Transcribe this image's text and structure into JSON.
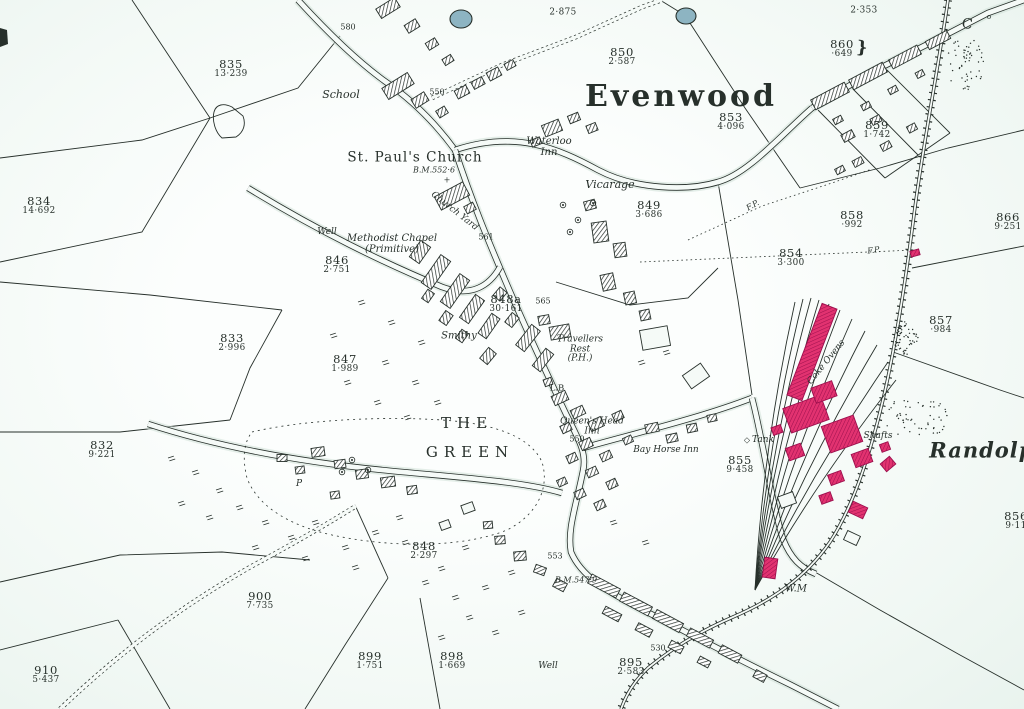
{
  "map": {
    "title": "Evenwood",
    "colors": {
      "paper": "#f5faf7",
      "ink": "#27302b",
      "pink": "#e23270",
      "pink_dark": "#9c0f4d",
      "pond": "#8db4c2",
      "road_halo": "#cfe0d7"
    },
    "parcels": [
      {
        "num": "835",
        "area": "13·239",
        "x": 231,
        "y": 69
      },
      {
        "num": "834",
        "area": "14·692",
        "x": 39,
        "y": 206
      },
      {
        "num": "",
        "area": "2·875",
        "x": 563,
        "y": 13
      },
      {
        "num": "850",
        "area": "2·587",
        "x": 622,
        "y": 57
      },
      {
        "num": "",
        "area": "2·353",
        "x": 864,
        "y": 11
      },
      {
        "num": "860",
        "area": "·649",
        "x": 842,
        "y": 49
      },
      {
        "num": "853",
        "area": "4·096",
        "x": 731,
        "y": 122
      },
      {
        "num": "859",
        "area": "1·742",
        "x": 877,
        "y": 130
      },
      {
        "num": "849",
        "area": "3·686",
        "x": 649,
        "y": 210
      },
      {
        "num": "858",
        "area": "·992",
        "x": 852,
        "y": 220
      },
      {
        "num": "866",
        "area": "9·251",
        "x": 1008,
        "y": 222
      },
      {
        "num": "854",
        "area": "3·300",
        "x": 791,
        "y": 258
      },
      {
        "num": "846",
        "area": "2·751",
        "x": 337,
        "y": 265
      },
      {
        "num": "848a",
        "area": "30·161",
        "x": 506,
        "y": 304
      },
      {
        "num": "857",
        "area": "·984",
        "x": 941,
        "y": 325
      },
      {
        "num": "833",
        "area": "2·996",
        "x": 232,
        "y": 343
      },
      {
        "num": "847",
        "area": "1·989",
        "x": 345,
        "y": 364
      },
      {
        "num": "832",
        "area": "9·221",
        "x": 102,
        "y": 450
      },
      {
        "num": "855",
        "area": "9·458",
        "x": 740,
        "y": 465
      },
      {
        "num": "856",
        "area": "9·11",
        "x": 1016,
        "y": 521
      },
      {
        "num": "848",
        "area": "2·297",
        "x": 424,
        "y": 551
      },
      {
        "num": "900",
        "area": "7·735",
        "x": 260,
        "y": 601
      },
      {
        "num": "899",
        "area": "1·751",
        "x": 370,
        "y": 661
      },
      {
        "num": "898",
        "area": "1·669",
        "x": 452,
        "y": 661
      },
      {
        "num": "895",
        "area": "2·583",
        "x": 631,
        "y": 667
      },
      {
        "num": "910",
        "area": "5·437",
        "x": 46,
        "y": 675
      }
    ],
    "labels": [
      {
        "text": "Evenwood",
        "x": 681,
        "y": 97,
        "cls": "title",
        "name": "settlement-name"
      },
      {
        "text": "THE",
        "x": 467,
        "y": 423,
        "cls": "green",
        "name": "the-green-name"
      },
      {
        "text": "GREEN",
        "x": 470,
        "y": 452,
        "cls": "green",
        "name": "the-green-name"
      },
      {
        "text": "St. Paul's Church",
        "x": 415,
        "y": 158,
        "cls": "roman-lg",
        "name": "church-name"
      },
      {
        "text": "Randolph",
        "x": 990,
        "y": 451,
        "cls": "randolph",
        "name": "randolph-name"
      },
      {
        "text": "School",
        "x": 341,
        "y": 95,
        "cls": "place-lg"
      },
      {
        "text": "Vicarage",
        "x": 610,
        "y": 185,
        "cls": "place-lg"
      },
      {
        "text": "Waterloo\nInn",
        "x": 549,
        "y": 148,
        "cls": "place"
      },
      {
        "text": "Methodist Chapel\n(Primitive)",
        "x": 392,
        "y": 245,
        "cls": "place"
      },
      {
        "text": "Smithy",
        "x": 459,
        "y": 337,
        "cls": "place"
      },
      {
        "text": "Travellers\nRest\n(P.H.)",
        "x": 580,
        "y": 350,
        "cls": "place-sm"
      },
      {
        "text": "Queen's Head\nInn",
        "x": 592,
        "y": 427,
        "cls": "place-sm"
      },
      {
        "text": "Bay Horse Inn",
        "x": 666,
        "y": 451,
        "cls": "place-sm"
      },
      {
        "text": "Church Yard",
        "x": 454,
        "y": 212,
        "cls": "place-sm",
        "rot": 38
      },
      {
        "text": "Coke Ovens",
        "x": 827,
        "y": 363,
        "cls": "place-sm",
        "rot": -51
      },
      {
        "text": "Shafts",
        "x": 878,
        "y": 437,
        "cls": "place-sm"
      },
      {
        "text": "Tank",
        "x": 763,
        "y": 441,
        "cls": "place-sm"
      },
      {
        "text": "◇",
        "x": 747,
        "y": 441,
        "cls": "spot",
        "name": "tank-symbol"
      },
      {
        "text": "Well",
        "x": 327,
        "y": 233,
        "cls": "place-sm"
      },
      {
        "text": "Well",
        "x": 548,
        "y": 667,
        "cls": "place-sm"
      },
      {
        "text": "W.M",
        "x": 796,
        "y": 590,
        "cls": "place"
      },
      {
        "text": "P",
        "x": 299,
        "y": 485,
        "cls": "place-sm"
      },
      {
        "text": "L.B",
        "x": 557,
        "y": 389,
        "cls": "roman-sm"
      },
      {
        "text": "C",
        "x": 967,
        "y": 25,
        "cls": "roman-md",
        "rot": 8
      },
      {
        "text": "o",
        "x": 989,
        "y": 18,
        "cls": "tiny"
      },
      {
        "text": "}",
        "x": 862,
        "y": 48,
        "cls": "brace",
        "rot": 5
      },
      {
        "text": "+",
        "x": 447,
        "y": 181,
        "cls": "spot",
        "name": "church-cross-symbol"
      },
      {
        "text": "B.M.552·6",
        "x": 434,
        "y": 171,
        "cls": "small-it"
      },
      {
        "text": "B.M.547·9",
        "x": 576,
        "y": 581,
        "cls": "small-it"
      },
      {
        "text": "F.P.",
        "x": 753,
        "y": 206,
        "cls": "small-it",
        "rot": -30
      },
      {
        "text": "F.P.",
        "x": 874,
        "y": 251,
        "cls": "small-it",
        "rot": -8
      },
      {
        "text": "580",
        "x": 348,
        "y": 28,
        "cls": "spot"
      },
      {
        "text": "550",
        "x": 437,
        "y": 93,
        "cls": "spot"
      },
      {
        "text": "561",
        "x": 486,
        "y": 238,
        "cls": "spot"
      },
      {
        "text": "565",
        "x": 543,
        "y": 302,
        "cls": "spot"
      },
      {
        "text": "550",
        "x": 577,
        "y": 440,
        "cls": "spot"
      },
      {
        "text": "553",
        "x": 555,
        "y": 557,
        "cls": "spot"
      },
      {
        "text": "530",
        "x": 658,
        "y": 649,
        "cls": "spot"
      }
    ]
  }
}
